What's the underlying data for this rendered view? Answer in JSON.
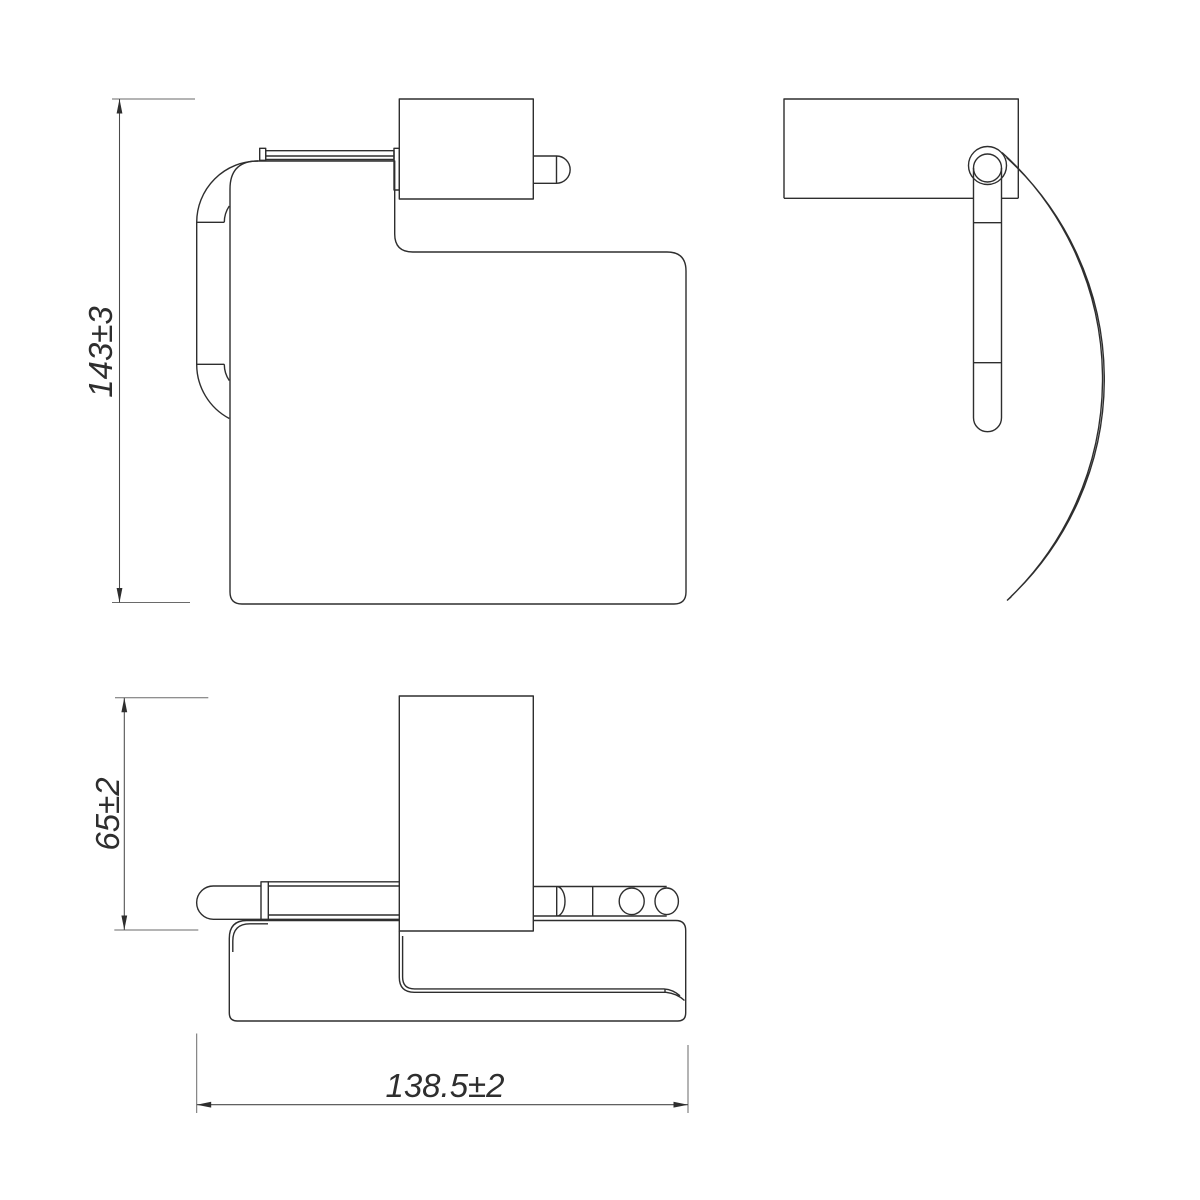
{
  "drawing": {
    "background_color": "#ffffff",
    "object_line_color": "#2e2e2e",
    "dimension_line_color": "#4a4a4a",
    "dimensions": {
      "height_label": "143±3",
      "depth_label": "65±2",
      "width_label": "138.5±2"
    }
  }
}
